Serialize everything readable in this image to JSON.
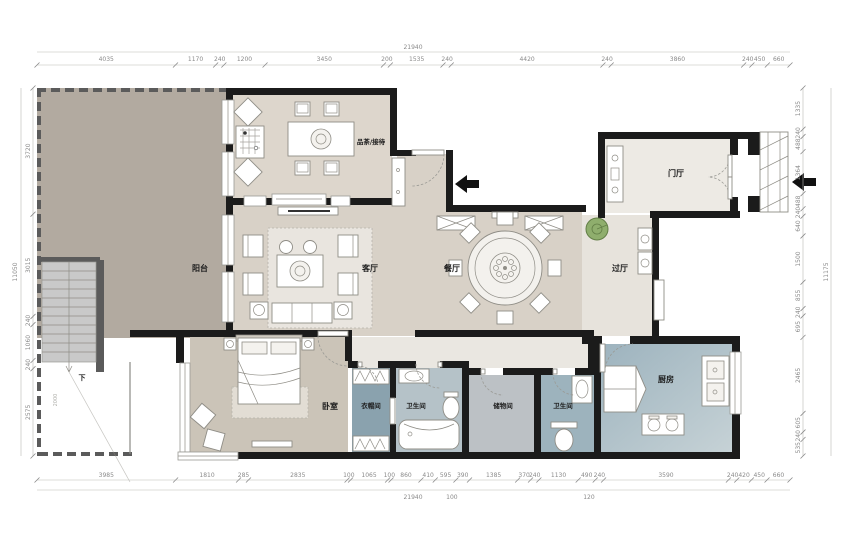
{
  "plan": {
    "type": "residential-floor-plan",
    "stair_note": "下",
    "stair_dim": "2000"
  },
  "rooms": {
    "tea": {
      "label": "品茶/接待"
    },
    "balcony": {
      "label": "阳台"
    },
    "living": {
      "label": "客厅"
    },
    "dining": {
      "label": "餐厅"
    },
    "hall": {
      "label": "过厅"
    },
    "foyer": {
      "label": "门厅"
    },
    "bedroom": {
      "label": "卧室"
    },
    "cloak": {
      "label": "衣帽间"
    },
    "bath1": {
      "label": "卫生间"
    },
    "storage": {
      "label": "储物间"
    },
    "bath2": {
      "label": "卫生间"
    },
    "kitchen": {
      "label": "厨房"
    }
  },
  "dimensions": {
    "top": {
      "total": "21940",
      "values": [
        "4035",
        "1170",
        "240",
        "1200",
        "3450",
        "200",
        "1535",
        "240",
        "4420",
        "240",
        "3860",
        "240",
        "450",
        "660"
      ]
    },
    "bottom": {
      "total": "21940",
      "values": [
        "3985",
        "1810",
        "285",
        "2835",
        "100",
        "1065",
        "100",
        "860",
        "410",
        "595",
        "390",
        "1385",
        "370",
        "240",
        "1130",
        "490",
        "240",
        "3590",
        "240",
        "420",
        "450",
        "660"
      ],
      "sub": [
        {
          "text": "100"
        },
        {
          "text": "120"
        }
      ]
    },
    "left": {
      "total": "11050",
      "values": [
        "3720",
        "3015",
        "240",
        "1060",
        "240",
        "2575"
      ]
    },
    "right": {
      "total": "11175",
      "values": [
        "1335",
        "240",
        "488",
        "1364",
        "488",
        "240",
        "640",
        "1500",
        "855",
        "240",
        "695",
        "2465",
        "605",
        "240",
        "535"
      ]
    }
  },
  "colors": {
    "wall": "#1b1b1b",
    "terrace_fill": "#b2aaa0",
    "main_floor": "#d8d1c7",
    "light_floor": "#e9e6df",
    "bedroom_floor": "#cbc4b8",
    "wet_blue": "#9db3bd",
    "cloak_blue": "#8aa2ae",
    "plant_green": "#8fae6d",
    "dim_text": "#8a8a8a"
  }
}
